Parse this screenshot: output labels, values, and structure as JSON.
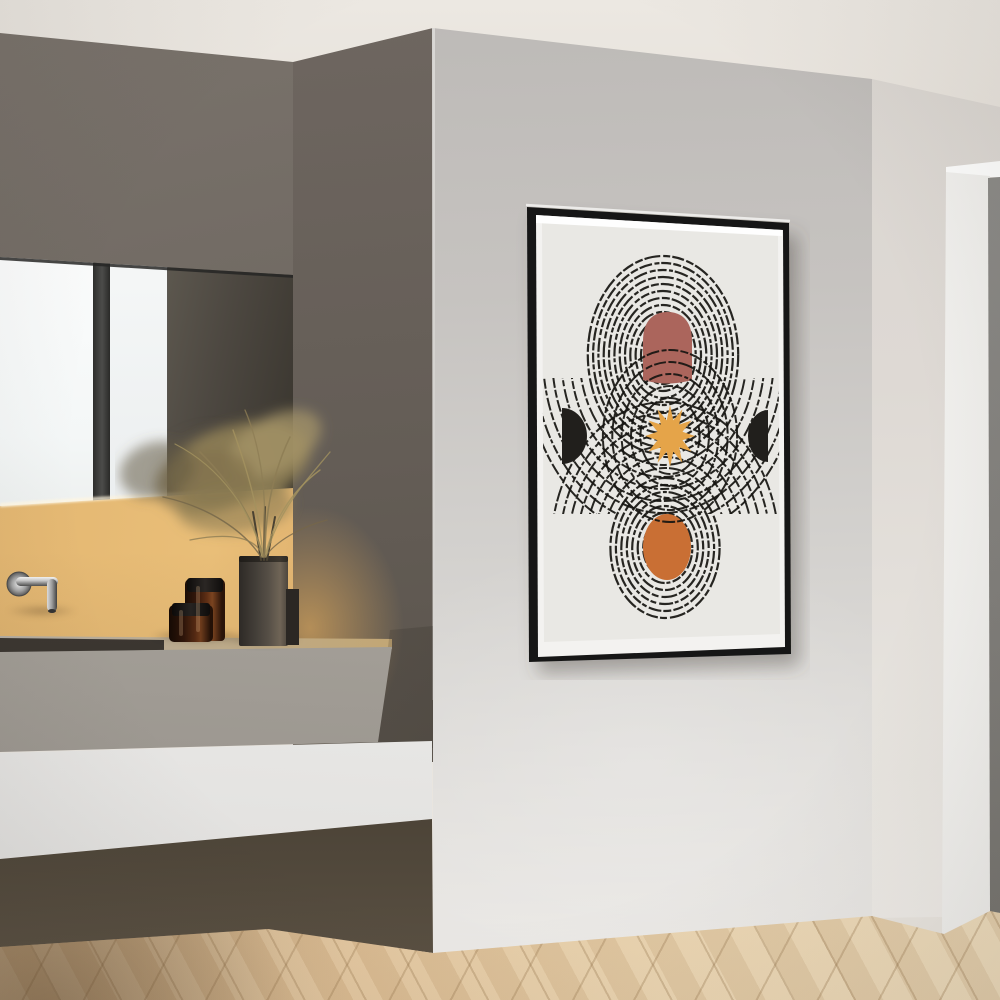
{
  "scene": {
    "type": "interior-photograph",
    "room": "bathroom",
    "description": "Modern minimalist bathroom: dark concrete wall with backlit mirror and floating concrete vanity (wall faucet, two amber glass jars, gray vase with dried pampas grass), light gray wall with a framed abstract art print, beige side wall with white doorway, light oak herringbone wood floor.",
    "wall_art_subject": "Mid-century abstract print: three stacked sets of distressed concentric rings, dusty-pink dome, ochre sun star, burnt-orange circle, two black half-moons"
  },
  "colors": {
    "ceiling": "#ece8e2",
    "wall_dark": "#6f6862",
    "wall_main": "#d3d1ce",
    "wall_side": "#ded9d4",
    "door_gray": "#8a8884",
    "floor_wood": "#e4cda7",
    "backsplash_glow": "#e8bd77",
    "counter_concrete": "#aba79f",
    "shelf_white": "#f0efed",
    "mirror_bright": "#f8fafa",
    "mirror_dark": "#45413b",
    "chrome": "#c9c9c9",
    "jar_amber": "#5f2f15",
    "vase_gray": "#564f46",
    "plume_tan": "#95855c",
    "poster_frame": "#191917",
    "poster_mat": "#f3f2f0",
    "poster_bg": "#e9e8e4",
    "ring_black": "#171512",
    "dome_pink": "#ab655c",
    "sun_ochre": "#e5a449",
    "circle_orange": "#c96f34",
    "halfmoon_black": "#211f1c"
  },
  "poster": {
    "frame": {
      "outer": [
        [
          17,
          17
        ],
        [
          279,
          33
        ],
        [
          281,
          464
        ],
        [
          19,
          472
        ]
      ],
      "mat": [
        [
          26,
          25
        ],
        [
          273,
          40
        ],
        [
          275,
          457
        ],
        [
          28,
          467
        ]
      ],
      "art": [
        [
          32,
          33
        ],
        [
          268,
          46
        ],
        [
          270,
          444
        ],
        [
          34,
          452
        ]
      ],
      "top_glare": [
        [
          26,
          25
        ],
        [
          272,
          40
        ],
        [
          272,
          46
        ],
        [
          26,
          33
        ]
      ],
      "top_edge_glare": [
        [
          16,
          15
        ],
        [
          280,
          31
        ]
      ],
      "frame_fill": "#191917",
      "mat_fill": "#f3f2f0"
    },
    "artwork": {
      "background": "#e9e8e4",
      "band": {
        "x": 28,
        "y": 188,
        "w": 250,
        "h": 136
      },
      "stroke": {
        "color": "#171512",
        "width": 2.2,
        "dashes": [
          "12 2.5 8 2 16 3 7 2.2",
          "8 2 13 2.5 5 1.8 10 2.2",
          "14 3 6 2 9 2.4 4 1.8"
        ]
      },
      "ring_sets": [
        {
          "name": "top",
          "cx": 153,
          "cy": 165,
          "ry_max": 99,
          "ry_min": 15,
          "count": 13,
          "squash": 0.76
        },
        {
          "name": "bottom",
          "cx": 155,
          "cy": 358,
          "ry_max": 70,
          "ry_min": 14,
          "count": 9,
          "squash": 0.78
        },
        {
          "name": "sun-rings",
          "cx": 160,
          "cy": 246,
          "ry_list": [
            38,
            50,
            62,
            74,
            86
          ],
          "squash": 0.78,
          "width": 2.0
        },
        {
          "name": "top-extended",
          "cx": 153,
          "cy": 165,
          "ry_list": [
            110,
            122,
            134,
            146,
            158,
            170,
            182
          ],
          "squash": 0.76,
          "clip": "band",
          "width": 2.0
        },
        {
          "name": "bottom-extended",
          "cx": 155,
          "cy": 358,
          "ry_list": [
            80,
            91,
            102,
            113,
            124,
            135,
            146
          ],
          "squash": 0.78,
          "clip": "band",
          "width": 2.0
        }
      ],
      "shapes": {
        "dome": {
          "x1": 133,
          "x2": 182,
          "cx": 157.5,
          "top": 122,
          "bottom": 190,
          "fill": "#ab655c"
        },
        "orange": {
          "cx": 157,
          "cy": 357,
          "rx": 24,
          "ry": 33,
          "fill": "#c96f34"
        },
        "halfmoon_left": {
          "x": 52,
          "cy": 246,
          "rx": 25,
          "ry": 28,
          "dir": "right",
          "fill": "#211f1c"
        },
        "halfmoon_right": {
          "x": 258,
          "cy": 246,
          "rx": 20,
          "ry": 26,
          "dir": "left",
          "fill": "#211f1c"
        },
        "sun": {
          "cx": 160,
          "cy": 246,
          "outer": 31,
          "inner_ratio": 0.52,
          "points": 12,
          "squash": 0.8,
          "fill": "#e5a449"
        }
      },
      "draw_order": [
        "rings:top",
        "rings:bottom",
        "shape:dome",
        "shape:orange",
        "rings:sun-rings",
        "rings:top-extended",
        "rings:bottom-extended",
        "shape:halfmoon_left",
        "shape:halfmoon_right",
        "shape:sun"
      ]
    }
  }
}
